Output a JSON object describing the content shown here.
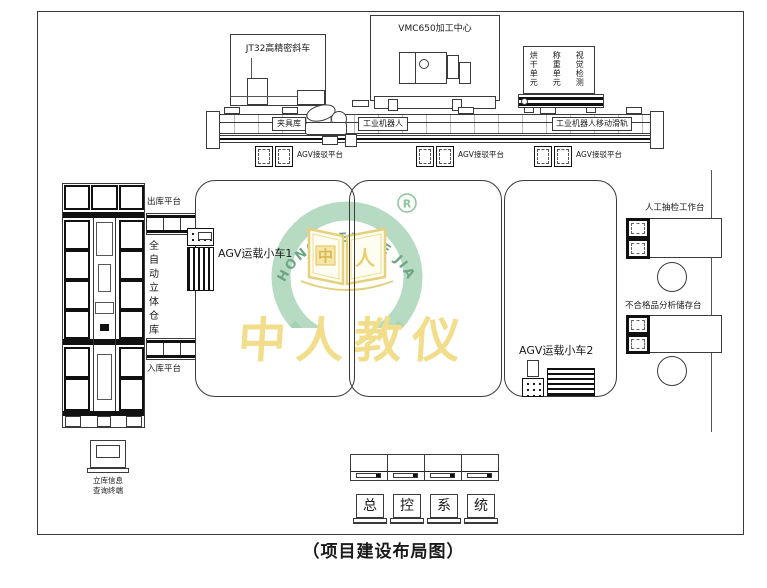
{
  "page": {
    "caption": "（项目建设布局图）"
  },
  "machines": {
    "lathe_label": "JT32高精密斜车",
    "vmc_label": "VMC650加工中心",
    "unit_columns": [
      "烘干单元",
      "称重单元",
      "视觉检测"
    ]
  },
  "rail": {
    "fixture_store": "夹具库",
    "robot": "工业机器人",
    "robot_rail": "工业机器人移动滑轨",
    "dock_label": "AGV接驳平台"
  },
  "warehouse": {
    "out_platform": "出库平台",
    "in_platform": "入库平台",
    "name_vertical": "全自动立体仓库",
    "terminal_line1": "立库信息",
    "terminal_line2": "查询终端"
  },
  "agv": {
    "cart1": "AGV运载小车1",
    "cart2": "AGV运载小车2"
  },
  "stations": {
    "manual_check": "人工抽检工作台",
    "defect_storage": "不合格品分析储存台"
  },
  "console": {
    "units": [
      "总",
      "控",
      "系",
      "统"
    ]
  },
  "watermark": {
    "arc_text": "ZHONG REN KE JIAO",
    "reg_mark": "R",
    "book_left": "中",
    "book_right": "人",
    "calligraphy": "中人教仪",
    "colors": {
      "ring_green": "#b7dbc2",
      "text_green": "#6ca785",
      "gold": "#f2dd8b",
      "book_gold": "#e5d07c"
    }
  }
}
